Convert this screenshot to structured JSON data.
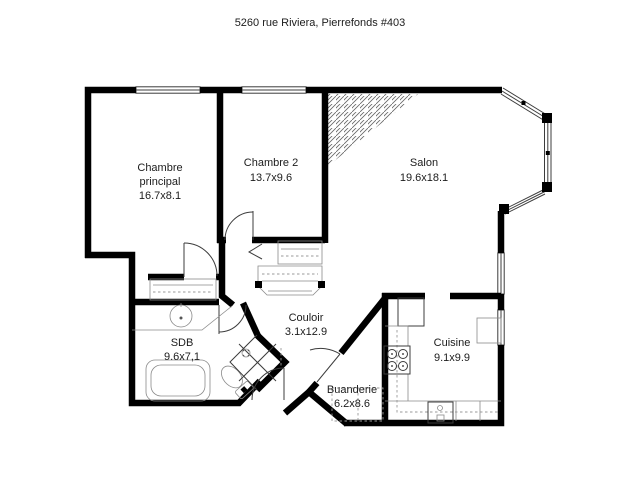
{
  "title": "5260 rue Riviera, Pierrefonds #403",
  "colors": {
    "walls": "#000000",
    "background": "#ffffff",
    "fixture_lines": "#3c3c3c"
  },
  "rooms": [
    {
      "id": "chambre-principal",
      "name": "Chambre",
      "name2": "principal",
      "dims": "16.7x8.1"
    },
    {
      "id": "chambre-2",
      "name": "Chambre 2",
      "dims": "13.7x9.6"
    },
    {
      "id": "salon",
      "name": "Salon",
      "dims": "19.6x18.1"
    },
    {
      "id": "couloir",
      "name": "Couloir",
      "dims": "3.1x12.9"
    },
    {
      "id": "sdb",
      "name": "SDB",
      "dims": "9.6x7,1"
    },
    {
      "id": "buanderie",
      "name": "Buanderie",
      "dims": "6.2x8.6"
    },
    {
      "id": "cuisine",
      "name": "Cuisine",
      "dims": "9.1x9.9"
    }
  ]
}
